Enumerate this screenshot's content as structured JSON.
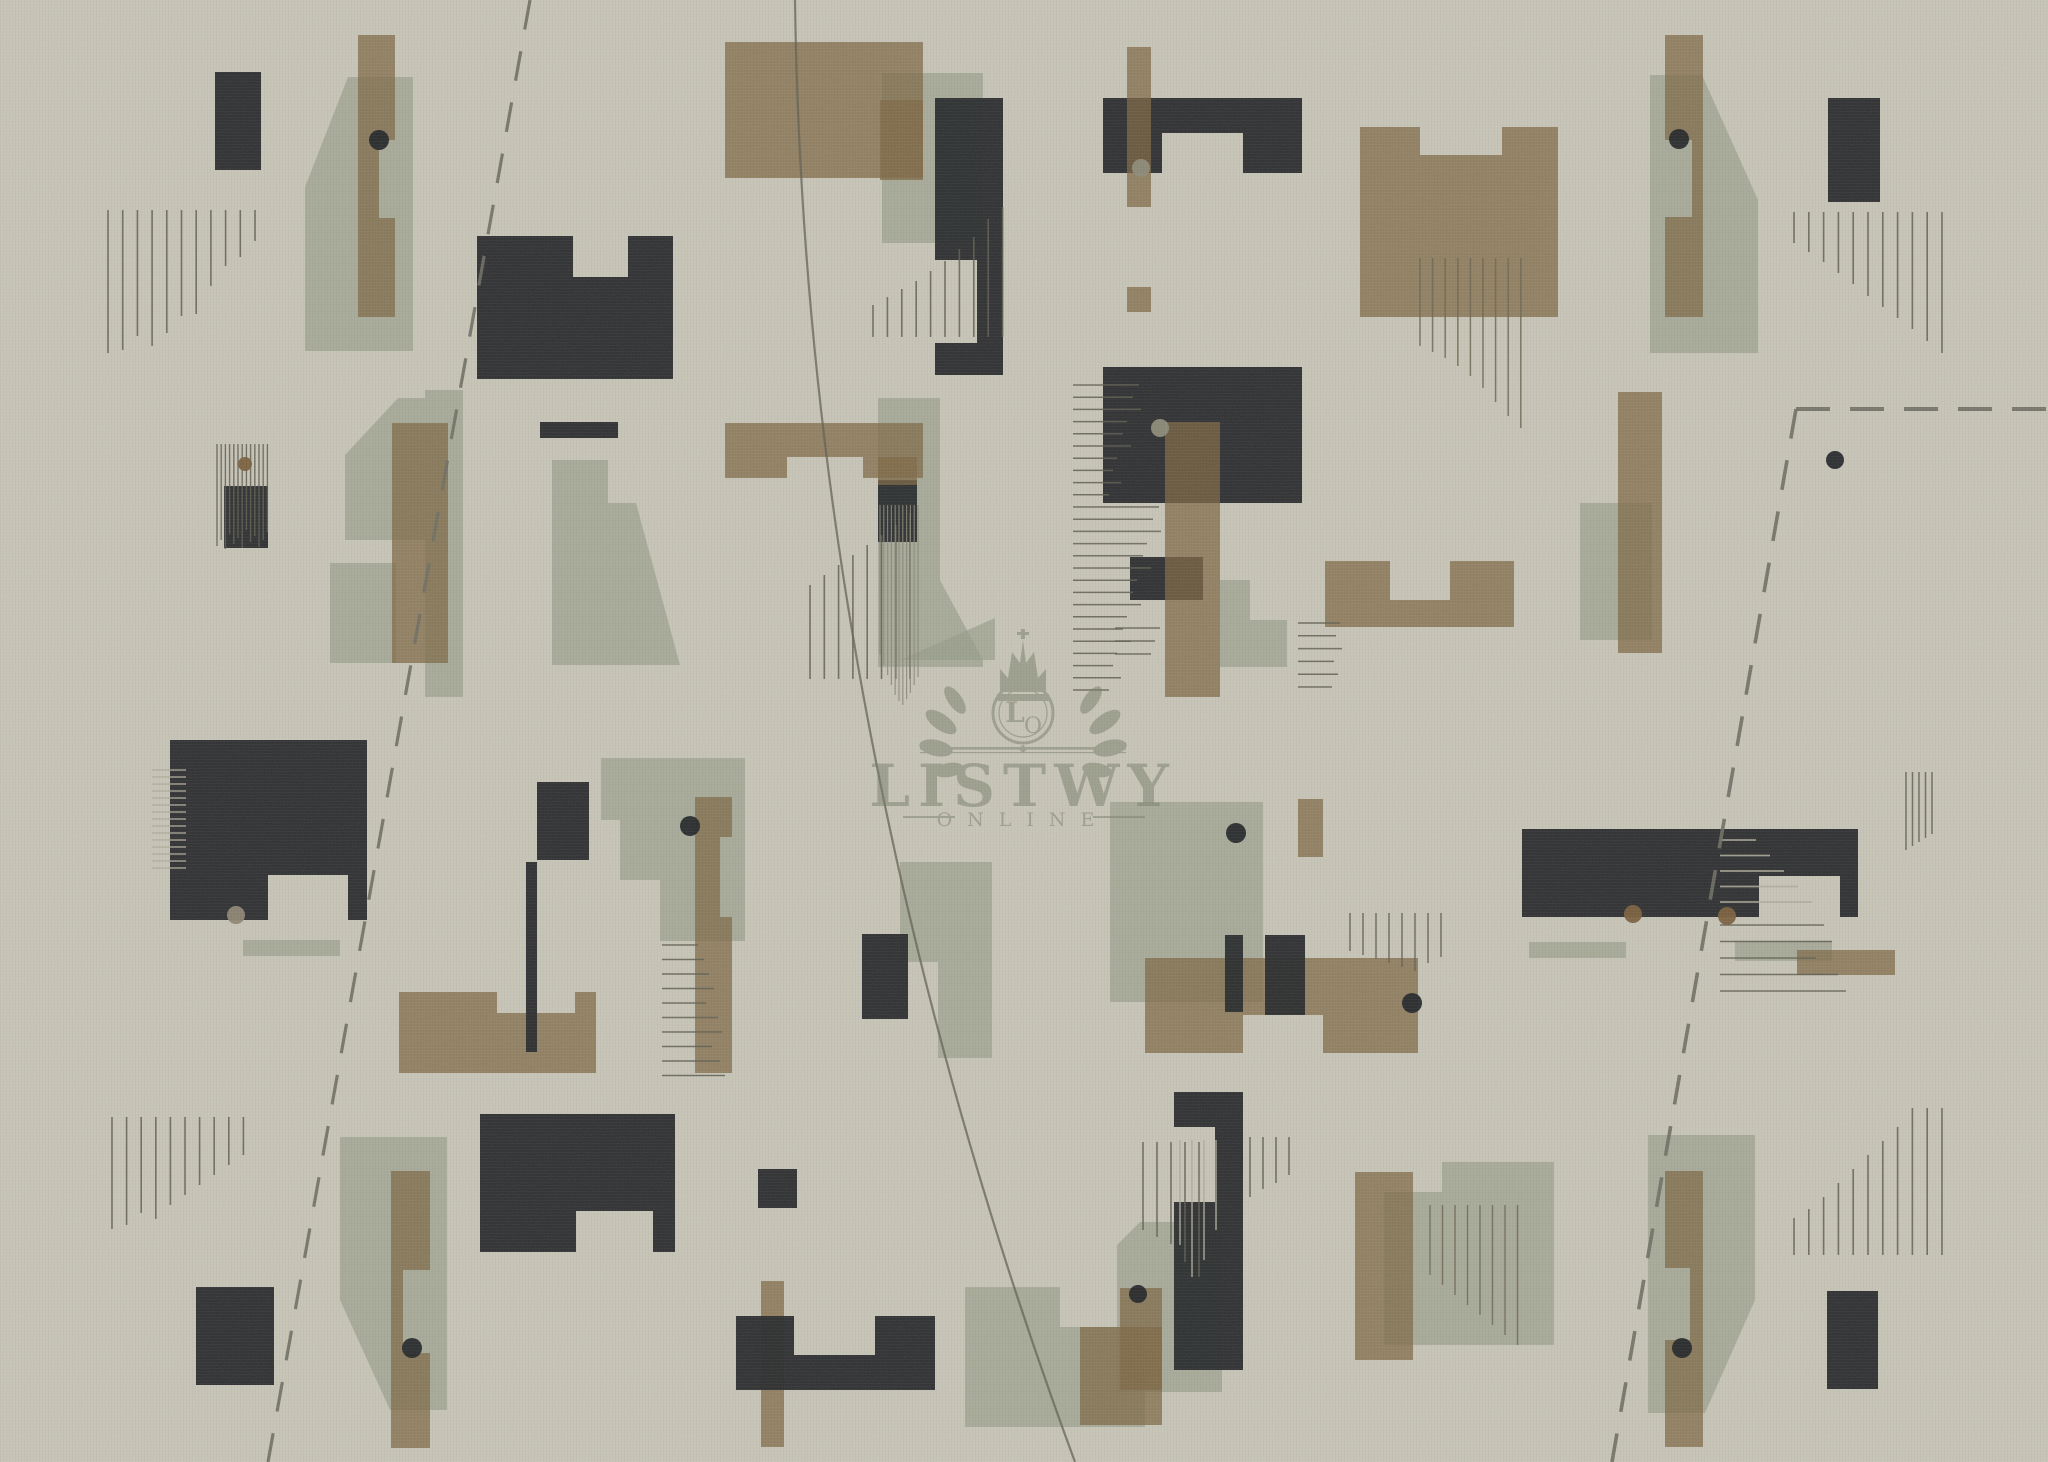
{
  "canvas": {
    "width": 2048,
    "height": 1462,
    "background": "#c9c6b9"
  },
  "palette": {
    "dark": "#26282a",
    "tan": "#7d6742",
    "tan_alpha": 0.74,
    "sage": "#969c89",
    "sage_alpha": 0.66,
    "line_dark": "#5e5d50",
    "line_light": "#b1ad9d",
    "line_mid": "#8a8779",
    "line_olive": "#6a6450",
    "dash_color": "#6e6d62",
    "dot_dark": "#202326",
    "dot_brown": "#7a5e3b",
    "dot_gray": "#8d8b78",
    "dot_graytan": "#8e8573",
    "watermark_color": "#737a65"
  },
  "watermark": {
    "brand": "LISTWY",
    "sub": "ONLINE",
    "monogram_l": "L",
    "monogram_o": "O"
  },
  "shapes": {
    "sage": [
      {
        "poly": "348,77 413,77 413,351 305,351 305,187"
      },
      {
        "rect": [
          425,
          390,
          38,
          307
        ]
      },
      {
        "poly": "345,455 398,398 425,398 425,540 345,540"
      },
      {
        "rect": [
          330,
          563,
          66,
          100
        ]
      },
      {
        "poly": "552,460 608,460 608,503 636,503 680,665 552,665"
      },
      {
        "rect": [
          882,
          73,
          101,
          170
        ]
      },
      {
        "poly": "878,398 940,398 940,580 983,660 983,667 878,667"
      },
      {
        "poly": "601,758 745,758 745,941 660,941 660,880 620,880 620,820 601,820"
      },
      {
        "poly": "900,862 992,862 992,1058 938,1058 938,962 900,962"
      },
      {
        "rect": [
          1580,
          503,
          72,
          137
        ]
      },
      {
        "rect": [
          1110,
          802,
          153,
          200
        ]
      },
      {
        "poly": "900,660 995,618 995,660"
      },
      {
        "poly": "340,1137 447,1137 447,1410 390,1410 340,1300"
      },
      {
        "poly": "965,1287 1060,1287 1060,1327 1145,1327 1145,1427 965,1427"
      },
      {
        "poly": "1140,1222 1222,1222 1222,1392 1117,1392 1117,1245"
      },
      {
        "poly": "1384,1192 1442,1192 1442,1162 1554,1162 1554,1345 1384,1345"
      },
      {
        "poly": "1648,1135 1755,1135 1755,1300 1705,1413 1648,1413"
      },
      {
        "poly": "1650,75 1702,75 1758,200 1758,353 1650,353"
      },
      {
        "rect": [
          243,
          940,
          97,
          16
        ]
      },
      {
        "rect": [
          1529,
          942,
          97,
          16
        ]
      },
      {
        "rect": [
          1735,
          941,
          97,
          20
        ]
      },
      {
        "poly": "1220,580 1250,580 1250,620 1287,620 1287,667 1220,667"
      }
    ],
    "tan": [
      {
        "poly": "358,35 395,35 395,140 379,140 379,218 395,218 395,317 358,317"
      },
      {
        "rect": [
          725,
          42,
          198,
          136
        ]
      },
      {
        "rect": [
          880,
          100,
          43,
          80
        ]
      },
      {
        "poly": "1360,127 1420,127 1420,155 1502,155 1502,127 1558,127 1558,317 1360,317"
      },
      {
        "poly": "725,423 923,423 923,478 863,478 863,457 787,457 787,478 725,478"
      },
      {
        "rect": [
          392,
          423,
          56,
          240
        ]
      },
      {
        "poly": "399,992 497,992 497,1013 575,1013 575,992 596,992 596,1073 399,1073"
      },
      {
        "poly": "1325,561 1390,561 1390,600 1450,600 1450,561 1514,561 1514,627 1325,627"
      },
      {
        "poly": "1145,958 1418,958 1418,1053 1323,1053 1323,1015 1243,1015 1243,1053 1145,1053"
      },
      {
        "rect": [
          1298,
          799,
          25,
          58
        ]
      },
      {
        "poly": "391,1171 430,1171 430,1270 403,1270 403,1353 430,1353 430,1448 391,1448"
      },
      {
        "poly": "1665,1171 1703,1171 1703,1447 1665,1447 1665,1340 1690,1340 1690,1268 1665,1268"
      },
      {
        "poly": "1665,35 1703,35 1703,317 1665,317 1665,217 1692,217 1692,140 1665,140"
      },
      {
        "rect": [
          761,
          1281,
          23,
          166
        ]
      },
      {
        "rect": [
          1080,
          1327,
          82,
          98
        ]
      },
      {
        "rect": [
          1120,
          1288,
          42,
          102
        ]
      },
      {
        "rect": [
          1355,
          1172,
          58,
          188
        ]
      },
      {
        "rect": [
          1797,
          950,
          98,
          25
        ]
      },
      {
        "poly": "695,797 732,797 732,837 720,837 720,917 732,917 732,1073 695,1073"
      },
      {
        "rect": [
          1618,
          392,
          44,
          261
        ]
      }
    ],
    "dark": [
      {
        "rect": [
          215,
          72,
          46,
          98
        ]
      },
      {
        "poly": "477,236 573,236 573,277 628,277 628,236 673,236 673,379 477,379"
      },
      {
        "rect": [
          540,
          422,
          78,
          16
        ]
      },
      {
        "rect": [
          224,
          486,
          44,
          62
        ]
      },
      {
        "poly": "1103,98 1302,98 1302,173 1243,173 1243,133 1162,133 1162,173 1103,173"
      },
      {
        "poly": "935,98 1003,98 1003,375 935,375 935,343 977,343 977,260 935,260"
      },
      {
        "rect": [
          1103,
          367,
          199,
          136
        ]
      },
      {
        "rect": [
          1130,
          557,
          73,
          43
        ]
      },
      {
        "rect": [
          1828,
          98,
          52,
          104
        ]
      },
      {
        "poly": "170,740 367,740 367,920 348,920 348,875 268,875 268,920 170,920"
      },
      {
        "rect": [
          537,
          782,
          52,
          78
        ]
      },
      {
        "rect": [
          526,
          862,
          11,
          190
        ]
      },
      {
        "rect": [
          862,
          934,
          46,
          85
        ]
      },
      {
        "rect": [
          878,
          480,
          39,
          62
        ]
      },
      {
        "rect": [
          1225,
          935,
          18,
          77
        ]
      },
      {
        "rect": [
          1265,
          935,
          40,
          80
        ]
      },
      {
        "poly": "1522,829 1858,829 1858,917 1840,917 1840,876 1759,876 1759,917 1522,917"
      },
      {
        "rect": [
          196,
          1287,
          78,
          98
        ]
      },
      {
        "poly": "480,1114 675,1114 675,1252 653,1252 653,1211 576,1211 576,1252 480,1252"
      },
      {
        "rect": [
          758,
          1169,
          39,
          39
        ]
      },
      {
        "poly": "736,1316 794,1316 794,1355 875,1355 875,1316 935,1316 935,1390 736,1390"
      },
      {
        "poly": "1174,1092 1243,1092 1243,1370 1174,1370 1174,1202 1215,1202 1215,1127 1174,1127"
      },
      {
        "rect": [
          1827,
          1291,
          51,
          98
        ]
      }
    ],
    "top_tan": [
      {
        "rect": [
          1127,
          47,
          24,
          160
        ]
      },
      {
        "rect": [
          1127,
          287,
          24,
          25
        ]
      },
      {
        "rect": [
          1165,
          422,
          55,
          275
        ]
      },
      {
        "rect": [
          878,
          457,
          39,
          28
        ]
      }
    ]
  },
  "hatches": [
    {
      "o": "v",
      "x": 108,
      "y": 210,
      "sp": 14.7,
      "w": 1.6,
      "tone": "dark",
      "lens": [
        143,
        140,
        126,
        136,
        123,
        106,
        104,
        76,
        56,
        47,
        31
      ]
    },
    {
      "o": "v",
      "x": 217,
      "y": 444,
      "sp": 4.2,
      "w": 1.4,
      "tone": "dark",
      "lens": [
        102,
        96,
        105,
        90,
        100,
        94,
        104,
        86,
        98,
        92,
        103,
        96,
        88
      ]
    },
    {
      "o": "v",
      "x": 873,
      "end": 337,
      "sp": 14.4,
      "w": 1.6,
      "tone": "dark",
      "lens": [
        32,
        40,
        48,
        56,
        66,
        76,
        88,
        100,
        118,
        130
      ]
    },
    {
      "o": "v",
      "x": 810,
      "end": 679,
      "sp": 14.3,
      "w": 1.6,
      "tone": "dark",
      "lens": [
        94,
        104,
        114,
        124,
        134,
        144,
        154,
        166
      ]
    },
    {
      "o": "v",
      "x": 880,
      "y": 505,
      "sp": 3.8,
      "w": 1.2,
      "tone": "mid",
      "lens": [
        150,
        160,
        170,
        180,
        190,
        196,
        200,
        194,
        188,
        180,
        172
      ]
    },
    {
      "o": "h",
      "x": 662,
      "y": 945,
      "sp": 14.5,
      "w": 1.6,
      "tone": "dark",
      "lens": [
        36,
        42,
        47,
        52,
        44,
        56,
        60,
        50,
        58,
        63
      ]
    },
    {
      "o": "h",
      "x": 152,
      "y": 770,
      "sp": 7,
      "w": 1.6,
      "tone": "light",
      "lens": [
        34,
        34,
        34,
        34,
        34,
        34,
        34,
        34,
        34,
        34,
        34,
        34,
        34,
        34,
        34
      ]
    },
    {
      "o": "h",
      "x": 1073,
      "y": 385,
      "sp": 12.2,
      "w": 1.5,
      "tone": "dark",
      "lens": [
        66,
        60,
        68,
        54,
        50,
        58,
        44,
        40,
        48,
        36,
        86,
        80,
        88,
        74,
        70,
        78,
        64,
        60,
        68,
        54,
        50,
        58,
        44,
        40,
        48,
        36
      ]
    },
    {
      "o": "h",
      "x": 1298,
      "y": 623,
      "sp": 12.8,
      "w": 1.5,
      "tone": "dark",
      "lens": [
        42,
        38,
        44,
        36,
        40,
        34
      ]
    },
    {
      "o": "h",
      "x": 1115,
      "y": 628,
      "sp": 13,
      "w": 1.5,
      "tone": "dark",
      "lens": [
        45,
        40,
        36
      ]
    },
    {
      "o": "v",
      "x": 1350,
      "y": 913,
      "sp": 13,
      "w": 1.5,
      "tone": "dark",
      "lens": [
        38,
        42,
        46,
        50,
        54,
        58,
        50,
        44
      ]
    },
    {
      "o": "v",
      "x": 1906,
      "y": 772,
      "sp": 6.5,
      "w": 1.5,
      "tone": "dark",
      "lens": [
        78,
        74,
        70,
        66,
        62
      ]
    },
    {
      "o": "h",
      "x": 1720,
      "y": 840,
      "sp": 15.5,
      "w": 1.8,
      "tone": "light",
      "lens": [
        36,
        50,
        64,
        78,
        92
      ]
    },
    {
      "o": "h",
      "x": 1720,
      "y": 925,
      "sp": 16.5,
      "w": 1.6,
      "tone": "dark",
      "lens": [
        104,
        112,
        96,
        118,
        126
      ]
    },
    {
      "o": "v",
      "x": 1143,
      "y": 1142,
      "sp": 14,
      "w": 1.6,
      "tone": "dark",
      "lens": [
        88,
        95,
        102,
        120,
        135
      ]
    },
    {
      "o": "v",
      "x": 1180,
      "y": 1140,
      "sp": 12,
      "w": 1.6,
      "tone": "light",
      "lens": [
        105,
        137,
        120,
        90
      ]
    },
    {
      "o": "v",
      "x": 1250,
      "y": 1137,
      "sp": 13,
      "w": 1.6,
      "tone": "dark",
      "lens": [
        60,
        52,
        46,
        38
      ]
    },
    {
      "o": "v",
      "x": 1794,
      "end": 1255,
      "sp": 14.8,
      "w": 1.6,
      "tone": "dark",
      "lens": [
        37,
        46,
        58,
        72,
        86,
        100,
        114,
        128,
        147,
        147,
        147
      ]
    },
    {
      "o": "v",
      "x": 1794,
      "y": 212,
      "sp": 14.8,
      "w": 1.6,
      "tone": "dark",
      "lens": [
        31,
        40,
        50,
        61,
        72,
        84,
        95,
        106,
        117,
        129,
        141
      ]
    },
    {
      "o": "v",
      "x": 1420,
      "y": 258,
      "sp": 12.6,
      "w": 1.5,
      "tone": "olive",
      "lens": [
        88,
        94,
        100,
        108,
        118,
        130,
        144,
        158,
        170
      ]
    },
    {
      "o": "v",
      "x": 1430,
      "y": 1205,
      "sp": 12.5,
      "w": 1.4,
      "tone": "olive",
      "lens": [
        70,
        80,
        90,
        100,
        110,
        120,
        130,
        140
      ]
    },
    {
      "o": "v",
      "x": 112,
      "y": 1117,
      "sp": 14.6,
      "w": 1.6,
      "tone": "dark",
      "lens": [
        112,
        108,
        96,
        102,
        88,
        78,
        68,
        58,
        48,
        38
      ]
    }
  ],
  "dashed_lines": [
    {
      "x1": 530,
      "y1": 0,
      "x2": 268,
      "y2": 1462,
      "dash": "30 22",
      "w": 3.2
    },
    {
      "x1": 1796,
      "y1": 409,
      "x2": 2048,
      "y2": 409,
      "dash": "34 20",
      "w": 4
    },
    {
      "x1": 1796,
      "y1": 409,
      "x2": 1612,
      "y2": 1462,
      "dash": "30 22",
      "w": 3.6
    }
  ],
  "curve": {
    "path": "M 795,0 Q 805,731 1075,1462",
    "w": 2.2
  },
  "dots": [
    {
      "x": 379,
      "y": 140,
      "r": 10,
      "c": "dot_dark"
    },
    {
      "x": 1141,
      "y": 168,
      "r": 9,
      "c": "dot_gray"
    },
    {
      "x": 245,
      "y": 464,
      "r": 7,
      "c": "dot_brown"
    },
    {
      "x": 1160,
      "y": 428,
      "r": 9,
      "c": "dot_gray"
    },
    {
      "x": 1835,
      "y": 460,
      "r": 9,
      "c": "dot_dark"
    },
    {
      "x": 690,
      "y": 826,
      "r": 10,
      "c": "dot_dark"
    },
    {
      "x": 1236,
      "y": 833,
      "r": 10,
      "c": "dot_dark"
    },
    {
      "x": 236,
      "y": 915,
      "r": 9,
      "c": "dot_graytan"
    },
    {
      "x": 1412,
      "y": 1003,
      "r": 10,
      "c": "dot_dark"
    },
    {
      "x": 1633,
      "y": 914,
      "r": 9,
      "c": "dot_brown"
    },
    {
      "x": 1727,
      "y": 916,
      "r": 9,
      "c": "dot_brown"
    },
    {
      "x": 1679,
      "y": 139,
      "r": 10,
      "c": "dot_dark"
    },
    {
      "x": 412,
      "y": 1348,
      "r": 10,
      "c": "dot_dark"
    },
    {
      "x": 1682,
      "y": 1348,
      "r": 10,
      "c": "dot_dark"
    },
    {
      "x": 1138,
      "y": 1294,
      "r": 9,
      "c": "dot_dark"
    }
  ]
}
